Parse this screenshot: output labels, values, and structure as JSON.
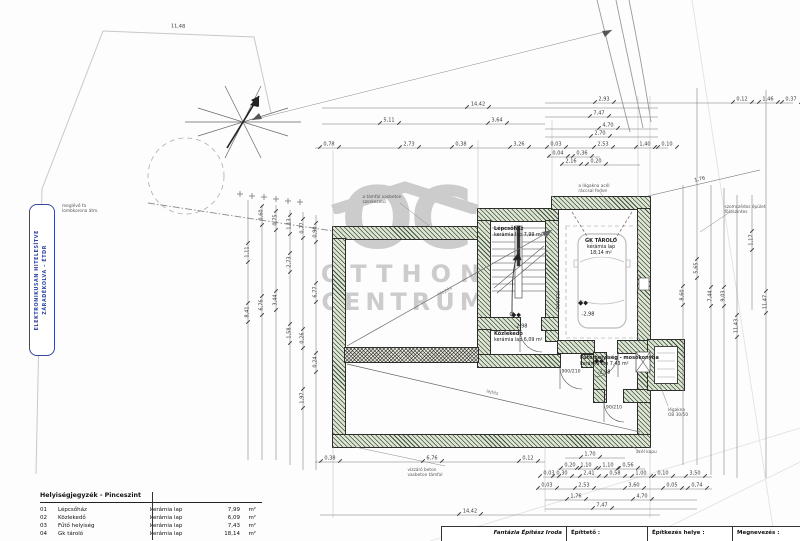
{
  "stamp": {
    "line1": "ELEKTRONIKUSAN HITELESÍTVE",
    "line2": "ZÁRADÉKOLVA – ÉTDR"
  },
  "watermark": {
    "monogram": "OC",
    "line1": "OTTHON",
    "line2": "CENTRUM"
  },
  "legend": {
    "title": "Helyiségjegyzék - Pinceszint",
    "rows": [
      {
        "num": "01",
        "name": "Lépcsőház",
        "floor": "kerámia lap",
        "area": "7,99",
        "unit": "m²"
      },
      {
        "num": "02",
        "name": "Közlekedő",
        "floor": "kerámia lap",
        "area": "6,09",
        "unit": "m²"
      },
      {
        "num": "03",
        "name": "Fűtő helyiség",
        "floor": "kerámia lap",
        "area": "7,43",
        "unit": "m²"
      },
      {
        "num": "04",
        "name": "Gk tároló",
        "floor": "kerámia lap",
        "area": "18,14",
        "unit": "m²"
      }
    ]
  },
  "titleblock": {
    "company": "Fantázia Építész Iroda",
    "builder_label": "Építtető :",
    "site_label": "Építkezés helye :",
    "name_label": "Megnevezés :"
  },
  "room_labels": [
    {
      "x": 494,
      "y": 226,
      "align": "l",
      "lines": [
        "Lépcsőház",
        "kerámia lap    7,99 m²"
      ]
    },
    {
      "x": 601,
      "y": 238,
      "align": "c",
      "lines": [
        "GK TÁROLÓ",
        "kerámia lap",
        "18,14 m²"
      ]
    },
    {
      "x": 494,
      "y": 331,
      "align": "l",
      "lines": [
        "Közlekedő",
        "kerámia lap    6,09 m²"
      ]
    },
    {
      "x": 580,
      "y": 355,
      "align": "l",
      "lines": [
        "Fűtő helyiség - mosókonyha",
        "kerámia lap    7,43 m²"
      ]
    }
  ],
  "levels": [
    {
      "x": 520,
      "y": 317,
      "v": "-2,98"
    },
    {
      "x": 587,
      "y": 305,
      "v": "-2,98"
    },
    {
      "x": 603,
      "y": 363,
      "v": "-2,98"
    }
  ],
  "door_labels": [
    {
      "x": 560,
      "y": 300,
      "v": "900/210",
      "o": "v"
    },
    {
      "x": 571,
      "y": 373,
      "v": "900/210",
      "o": "h"
    },
    {
      "x": 614,
      "y": 409,
      "v": "90/210",
      "o": "h"
    }
  ],
  "slope_labels": [
    {
      "x": 447,
      "y": 292,
      "v": "lejtés",
      "o": -29
    },
    {
      "x": 492,
      "y": 394,
      "v": "lejtés",
      "o": 13
    }
  ],
  "dims": [
    {
      "x": 604,
      "y": 100,
      "v": "2,93",
      "o": "h"
    },
    {
      "x": 742,
      "y": 100,
      "v": "0,12",
      "o": "h"
    },
    {
      "x": 768,
      "y": 100,
      "v": "1,46",
      "o": "h"
    },
    {
      "x": 791,
      "y": 100,
      "v": "0,37",
      "o": "h"
    },
    {
      "x": 478,
      "y": 105,
      "v": "14,42",
      "o": "h"
    },
    {
      "x": 599,
      "y": 114,
      "v": "7,47",
      "o": "h"
    },
    {
      "x": 389,
      "y": 121,
      "v": "5,11",
      "o": "h"
    },
    {
      "x": 497,
      "y": 121,
      "v": "3,64",
      "o": "h"
    },
    {
      "x": 608,
      "y": 126,
      "v": "4,70",
      "o": "h"
    },
    {
      "x": 600,
      "y": 134,
      "v": "2,70",
      "o": "h"
    },
    {
      "x": 329,
      "y": 145,
      "v": "0,78",
      "o": "h"
    },
    {
      "x": 409,
      "y": 145,
      "v": "2,73",
      "o": "h"
    },
    {
      "x": 461,
      "y": 145,
      "v": "0,38",
      "o": "h"
    },
    {
      "x": 519,
      "y": 145,
      "v": "3,26",
      "o": "h"
    },
    {
      "x": 556,
      "y": 145,
      "v": "0,03",
      "o": "h"
    },
    {
      "x": 603,
      "y": 145,
      "v": "2,53",
      "o": "h"
    },
    {
      "x": 645,
      "y": 145,
      "v": "1,40",
      "o": "h"
    },
    {
      "x": 667,
      "y": 145,
      "v": "0,10",
      "o": "h"
    },
    {
      "x": 558,
      "y": 154,
      "v": "0,04",
      "o": "h"
    },
    {
      "x": 582,
      "y": 154,
      "v": "0,36",
      "o": "h"
    },
    {
      "x": 571,
      "y": 162,
      "v": "2,16",
      "o": "h"
    },
    {
      "x": 596,
      "y": 162,
      "v": "0,20",
      "o": "h"
    },
    {
      "x": 178,
      "y": 27,
      "v": "11,48",
      "o": 2
    },
    {
      "x": 248,
      "y": 252,
      "v": "1,11",
      "o": "v"
    },
    {
      "x": 248,
      "y": 312,
      "v": "8,41",
      "o": "v"
    },
    {
      "x": 262,
      "y": 215,
      "v": "0,60",
      "o": "v"
    },
    {
      "x": 262,
      "y": 305,
      "v": "6,76",
      "o": "v"
    },
    {
      "x": 276,
      "y": 220,
      "v": "0,75",
      "o": "v"
    },
    {
      "x": 276,
      "y": 300,
      "v": "3,44",
      "o": "v"
    },
    {
      "x": 290,
      "y": 224,
      "v": "1,13",
      "o": "v"
    },
    {
      "x": 290,
      "y": 262,
      "v": "2,73",
      "o": "v"
    },
    {
      "x": 290,
      "y": 333,
      "v": "1,58",
      "o": "v"
    },
    {
      "x": 303,
      "y": 228,
      "v": "0,77",
      "o": "v"
    },
    {
      "x": 303,
      "y": 338,
      "v": "0,26",
      "o": "v"
    },
    {
      "x": 303,
      "y": 398,
      "v": "1,97",
      "o": "v"
    },
    {
      "x": 316,
      "y": 232,
      "v": "0,90",
      "o": "v"
    },
    {
      "x": 316,
      "y": 292,
      "v": "6,77",
      "o": "v"
    },
    {
      "x": 316,
      "y": 362,
      "v": "0,24",
      "o": "v"
    },
    {
      "x": 683,
      "y": 295,
      "v": "8,60",
      "o": "v"
    },
    {
      "x": 697,
      "y": 268,
      "v": "5,65",
      "o": "v"
    },
    {
      "x": 711,
      "y": 296,
      "v": "7,44",
      "o": "v"
    },
    {
      "x": 724,
      "y": 296,
      "v": "9,03",
      "o": "v"
    },
    {
      "x": 737,
      "y": 326,
      "v": "11,43",
      "o": "v"
    },
    {
      "x": 752,
      "y": 240,
      "v": "1,17",
      "o": "v"
    },
    {
      "x": 766,
      "y": 302,
      "v": "11,47",
      "o": "v"
    },
    {
      "x": 700,
      "y": 180,
      "v": "1,76",
      "o": -13
    },
    {
      "x": 330,
      "y": 459,
      "v": "0,38",
      "o": "h"
    },
    {
      "x": 432,
      "y": 459,
      "v": "6,76",
      "o": "h"
    },
    {
      "x": 528,
      "y": 459,
      "v": "0,12",
      "o": "h"
    },
    {
      "x": 590,
      "y": 455,
      "v": "1,70",
      "o": "h"
    },
    {
      "x": 570,
      "y": 466,
      "v": "0,20",
      "o": "h"
    },
    {
      "x": 586,
      "y": 466,
      "v": "1,10",
      "o": "h"
    },
    {
      "x": 608,
      "y": 466,
      "v": "1,10",
      "o": "h"
    },
    {
      "x": 628,
      "y": 466,
      "v": "0,56",
      "o": "h"
    },
    {
      "x": 549,
      "y": 474,
      "v": "0,03",
      "o": "h"
    },
    {
      "x": 562,
      "y": 474,
      "v": "0,30",
      "o": "h"
    },
    {
      "x": 589,
      "y": 474,
      "v": "2,41",
      "o": "h"
    },
    {
      "x": 615,
      "y": 474,
      "v": "0,58",
      "o": "h"
    },
    {
      "x": 641,
      "y": 474,
      "v": "1,00",
      "o": "h"
    },
    {
      "x": 663,
      "y": 474,
      "v": "0,10",
      "o": "h"
    },
    {
      "x": 695,
      "y": 474,
      "v": "3,50",
      "o": "h"
    },
    {
      "x": 547,
      "y": 486,
      "v": "0,03",
      "o": "h"
    },
    {
      "x": 584,
      "y": 486,
      "v": "2,53",
      "o": "h"
    },
    {
      "x": 634,
      "y": 486,
      "v": "3,60",
      "o": "h"
    },
    {
      "x": 672,
      "y": 486,
      "v": "0,05",
      "o": "h"
    },
    {
      "x": 697,
      "y": 486,
      "v": "0,74",
      "o": "h"
    },
    {
      "x": 576,
      "y": 497,
      "v": "1,76",
      "o": "h"
    },
    {
      "x": 642,
      "y": 497,
      "v": "4,70",
      "o": "h"
    },
    {
      "x": 602,
      "y": 506,
      "v": "7,47",
      "o": "h"
    },
    {
      "x": 470,
      "y": 512,
      "v": "14,42",
      "o": "h"
    }
  ],
  "notes": [
    {
      "x": 62,
      "y": 204,
      "align": "l",
      "lines": [
        "meglévő fa",
        "lombkorona átm."
      ]
    },
    {
      "x": 382,
      "y": 195,
      "align": "c",
      "lines": [
        "a támfal vasbeton",
        "szerkezetű"
      ]
    },
    {
      "x": 594,
      "y": 184,
      "align": "c",
      "lines": [
        "a légakna acél",
        "ráccsal fedve"
      ]
    },
    {
      "x": 745,
      "y": 205,
      "align": "c",
      "lines": [
        "szomszédos épület",
        "földszintes"
      ]
    },
    {
      "x": 668,
      "y": 408,
      "align": "l",
      "lines": [
        "légakna",
        "OB 30/50"
      ]
    },
    {
      "x": 425,
      "y": 468,
      "align": "c",
      "lines": [
        "vízzáró beton",
        "vasbeton támfal"
      ]
    },
    {
      "x": 636,
      "y": 450,
      "align": "l",
      "lines": [
        "acél kapu"
      ]
    }
  ]
}
